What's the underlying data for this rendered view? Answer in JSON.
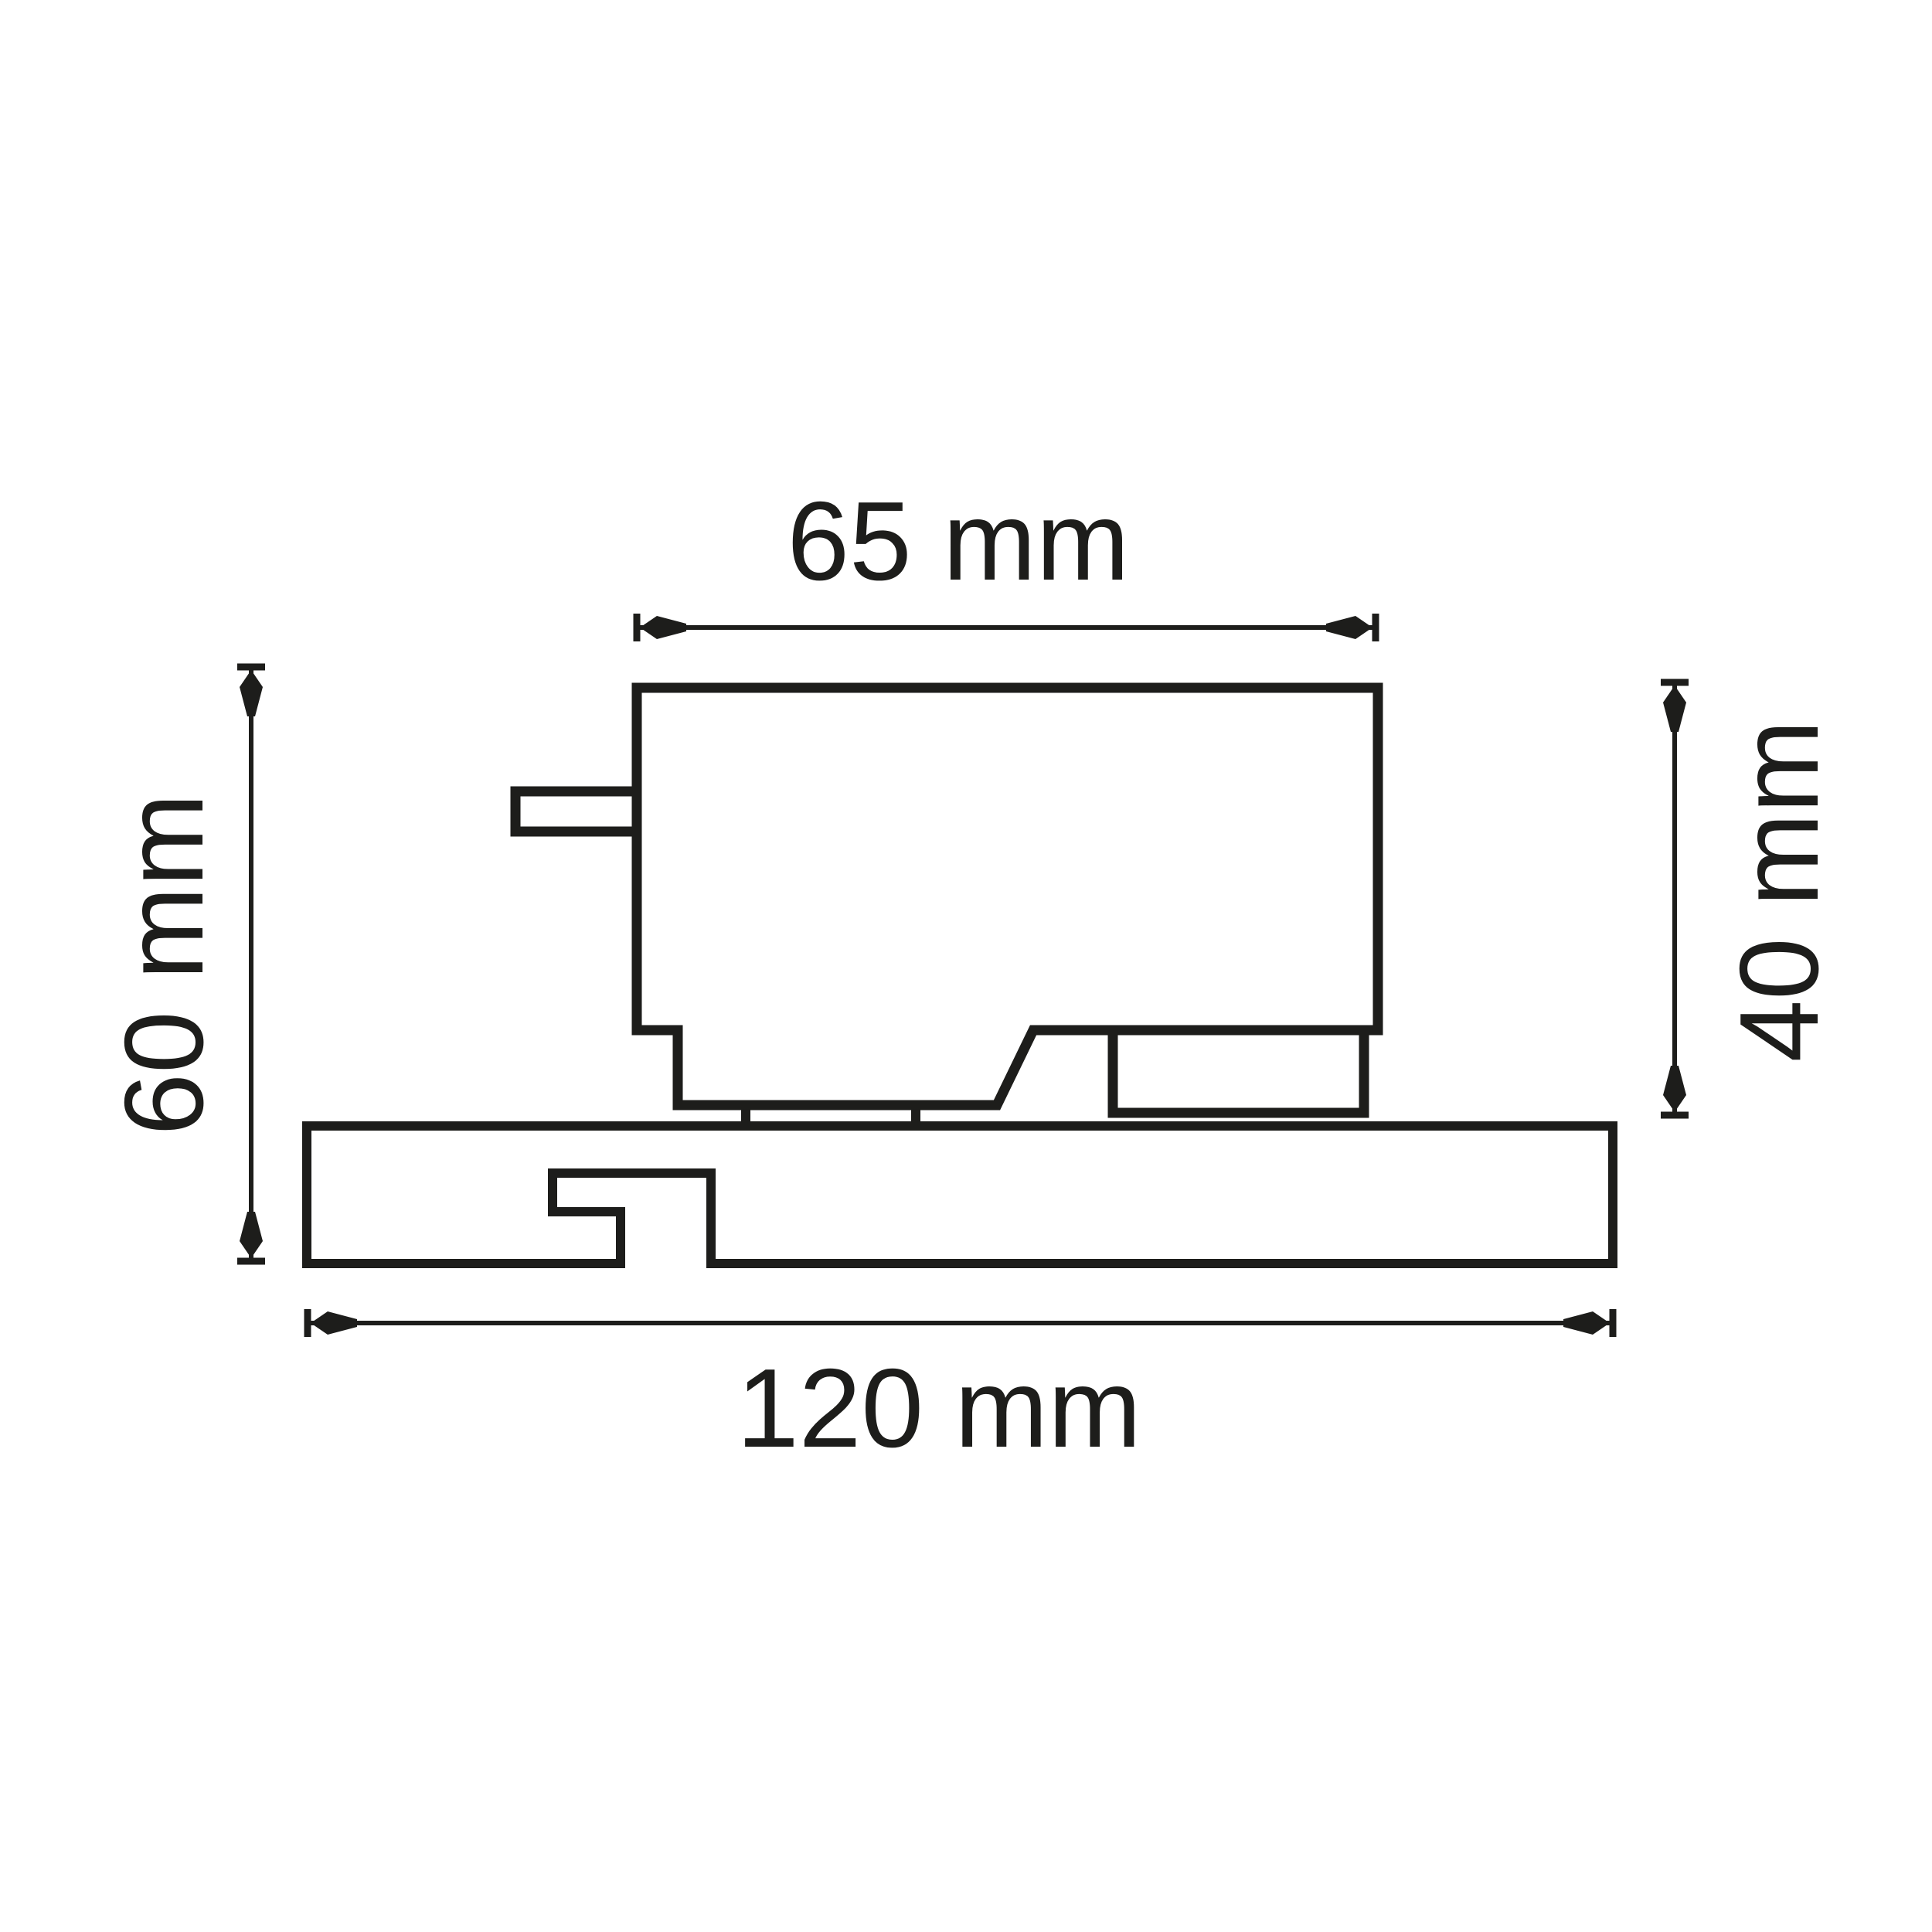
{
  "page": {
    "background_color": "#ffffff",
    "line_color": "#1d1d1b"
  },
  "drawing": {
    "kind": "technical-dimension-drawing",
    "unit": "mm",
    "dimensions": {
      "top_width": {
        "label": "65 mm",
        "value": 65,
        "unit": "mm",
        "orientation": "horizontal"
      },
      "left_height": {
        "label": "60 mm",
        "value": 60,
        "unit": "mm",
        "orientation": "vertical"
      },
      "right_height": {
        "label": "40 mm",
        "value": 40,
        "unit": "mm",
        "orientation": "vertical"
      },
      "bottom_width": {
        "label": "120 mm",
        "value": 120,
        "unit": "mm",
        "orientation": "horizontal"
      }
    }
  }
}
